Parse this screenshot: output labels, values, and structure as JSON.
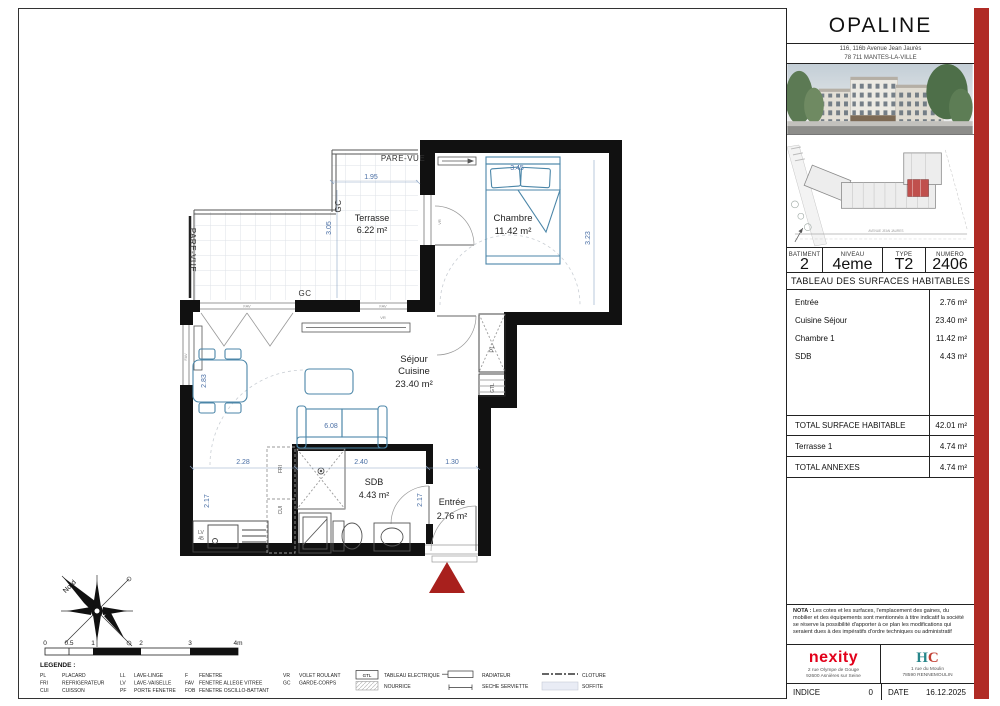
{
  "sheet": {
    "project": "OPALINE",
    "address1": "116, 116b Avenue Jean Jaurès",
    "address2": "78 711 MANTES-LA-VILLE"
  },
  "unit": {
    "headers": [
      "BATIMENT",
      "NIVEAU",
      "TYPE",
      "NUMERO"
    ],
    "values": [
      "2",
      "4eme",
      "T2",
      "2406"
    ]
  },
  "surfaces": {
    "title": "TABLEAU DES SURFACES HABITABLES",
    "rows": [
      {
        "label": "Entrée",
        "value": "2.76 m²"
      },
      {
        "label": "Cuisine Séjour",
        "value": "23.40 m²"
      },
      {
        "label": "Chambre 1",
        "value": "11.42 m²"
      },
      {
        "label": "SDB",
        "value": "4.43 m²"
      }
    ],
    "total_label": "TOTAL SURFACE HABITABLE",
    "total_value": "42.01 m²",
    "annexe_label": "Terrasse 1",
    "annexe_value": "4.74 m²",
    "total_annexes_label": "TOTAL ANNEXES",
    "total_annexes_value": "4.74 m²"
  },
  "nota": {
    "bold": "NOTA :",
    "text": " Les cotes et les surfaces, l'emplacement des gaines, du mobilier et des équipements sont mentionnés à titre indicatif la société se réserve la possibilité d'apporter à ce plan les modifications qui seraient dues à des impératifs d'ordre techniques ou administratif"
  },
  "footer": {
    "nexity": "nexity",
    "nexity_addr1": "2 rue Olympe de Gouge",
    "nexity_addr2": "92600 Asnières sur Seine",
    "hc_h": "H",
    "hc_c": "C",
    "hc_addr1": "1 rue du Moulin",
    "hc_addr2": "78590 RENNEMOULIN",
    "indice_label": "INDICE",
    "indice_value": "0",
    "date_label": "DATE",
    "date_value": "16.12.2025"
  },
  "site_plan": {
    "street": "AVENUE JEAN JAURES"
  },
  "plan": {
    "rooms": {
      "terrasse": {
        "name": "Terrasse",
        "area": "6.22 m²"
      },
      "chambre": {
        "name": "Chambre",
        "area": "11.42 m²"
      },
      "sejour_l1": "Séjour",
      "sejour_l2": "Cuisine",
      "sejour_area": "23.40 m²",
      "sdb": {
        "name": "SDB",
        "area": "4.43 m²"
      },
      "entree": {
        "name": "Entrée",
        "area": "2.76 m²"
      }
    },
    "dims": {
      "d195": "1.95",
      "d305": "3.05",
      "d345": "3.45",
      "d323": "3.23",
      "d283": "2.83",
      "d608": "6.08",
      "d228": "2.28",
      "d240": "2.40",
      "d130": "1.30",
      "d217a": "2.17",
      "d217b": "2.17"
    },
    "labels": {
      "pare_vue": "PARE-VUE",
      "gc": "GC",
      "pl": "PL",
      "gtl": "GTL",
      "fri": "FRI",
      "cui": "CUI",
      "lv": "LV",
      "lv_size": "45",
      "fav": "FAV",
      "vr": "VR",
      "nord": "Nord"
    }
  },
  "scalebar": {
    "t0": "0",
    "t05": "0.5",
    "t1": "1",
    "t2": "2",
    "t3": "3",
    "t4": "4m"
  },
  "legend": {
    "title": "LEGENDE :",
    "gtl": "GTL",
    "abbrs": [
      {
        "abbr": "PL",
        "name": "PLACARD"
      },
      {
        "abbr": "FRI",
        "name": "REFRIGERATEUR"
      },
      {
        "abbr": "CUI",
        "name": "CUISSON"
      },
      {
        "abbr": "LL",
        "name": "LAVE-LINGE"
      },
      {
        "abbr": "LV",
        "name": "LAVE-VAISELLE"
      },
      {
        "abbr": "PF",
        "name": "PORTE FENETRE"
      },
      {
        "abbr": "F",
        "name": "FENETRE"
      },
      {
        "abbr": "FAV",
        "name": "FENETRE ALLEGE VITREE"
      },
      {
        "abbr": "FOB",
        "name": "FENETRE OSCILLO-BATTANT"
      },
      {
        "abbr": "VR",
        "name": "VOLET ROULANT"
      },
      {
        "abbr": "GC",
        "name": "GARDE-CORPS"
      }
    ],
    "symbols": [
      "TABLEAU ELECTRIQUE",
      "NOURRICE",
      "RADIATEUR",
      "SECHE SERVIETTE",
      "CLOTURE",
      "SOFFITE"
    ]
  }
}
